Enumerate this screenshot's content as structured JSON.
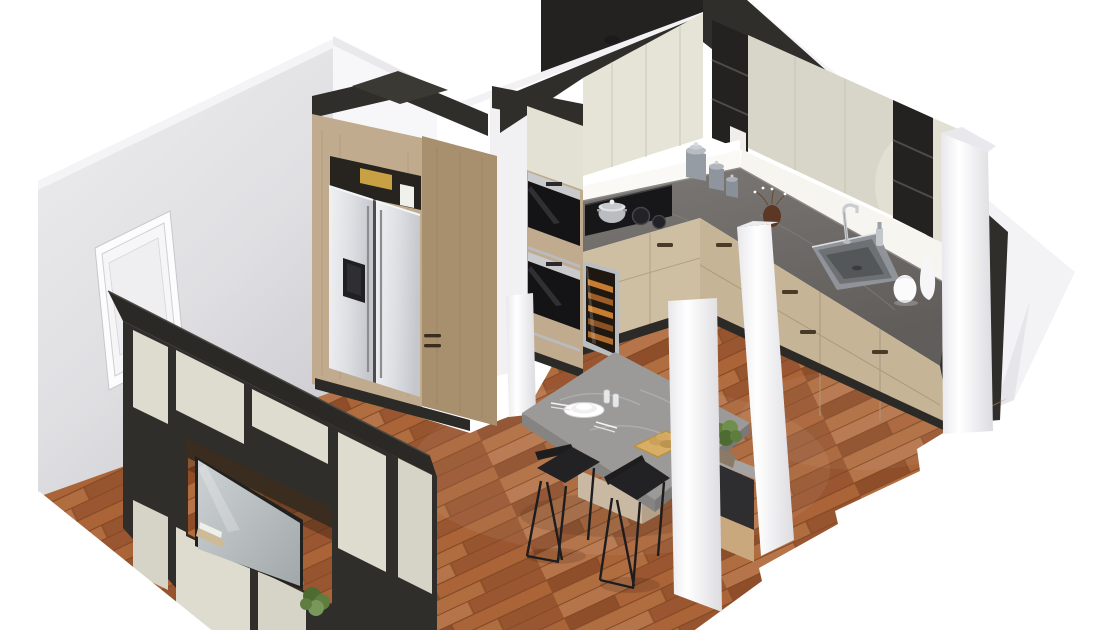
{
  "meta": {
    "title": "3D isometric kitchen interior render",
    "view": "dollhouse cutaway, no UI chrome, no visible text",
    "background": "#ffffff"
  },
  "palette": {
    "background": "#ffffff",
    "wall": "#e7e7ea",
    "wall_shadow": "#d2d2d6",
    "partition_white": "#f7f7f9",
    "dark_trim": "#302e2a",
    "dark_deep": "#232220",
    "cream": "#e6e4d7",
    "cream_shadow": "#d8d6c8",
    "wood": "#c0ab8e",
    "wood_dark": "#a8906f",
    "base_wood": "#cfbfa2",
    "counter": "#6f6b68",
    "counter_edge": "#55514e",
    "backsplash": "#faf9f5",
    "floor_base": "#a3613a",
    "floor_plank_light": "#b5744a",
    "floor_plank_dark": "#8f4e2a",
    "floor_seam": "#7c431f",
    "steel": "#d7d9dc",
    "black_appliance": "#17171a",
    "wine_orange": "#c87c32",
    "table_stone": "#9c9a98",
    "stool_black": "#1d1d1f",
    "pillar": "#f8f8fa",
    "plant_green": "#5f7d3f",
    "tray_tan": "#d8ae66",
    "tv_screen": "#b9bfc1",
    "door_white": "#f6f6f8"
  },
  "scene": {
    "rooms": [
      "kitchen",
      "dining-living area"
    ],
    "objects": [
      {
        "id": "left-wall",
        "label": "light gray wall with white interior door"
      },
      {
        "id": "media-wall",
        "label": "dark charcoal TV media wall with cream panels and wall TV"
      },
      {
        "id": "fridge-tower",
        "label": "tall oak cabinet with side-by-side stainless refrigerator"
      },
      {
        "id": "oven-tower",
        "label": "tall housing with two built-in ovens"
      },
      {
        "id": "wine-cooler",
        "label": "under-counter wine cooler with lit bottles"
      },
      {
        "id": "upper-cabinets",
        "label": "cream wall cabinets with dark open shelving and dark soffit"
      },
      {
        "id": "countertop",
        "label": "dark stone L-shaped countertop"
      },
      {
        "id": "cooktop",
        "label": "black induction cooktop with steel pot"
      },
      {
        "id": "canisters",
        "label": "three steel canisters on counter"
      },
      {
        "id": "sink-area",
        "label": "stainless sink, chrome faucet, white vases"
      },
      {
        "id": "dining-table",
        "label": "gray stone table with plates, glasses, tray and plant"
      },
      {
        "id": "bar-stools",
        "label": "two black metal bar stools"
      },
      {
        "id": "pillars",
        "label": "four white structural pillars"
      },
      {
        "id": "wood-floor",
        "label": "warm oak plank floor with stepped render cut-out"
      }
    ]
  }
}
